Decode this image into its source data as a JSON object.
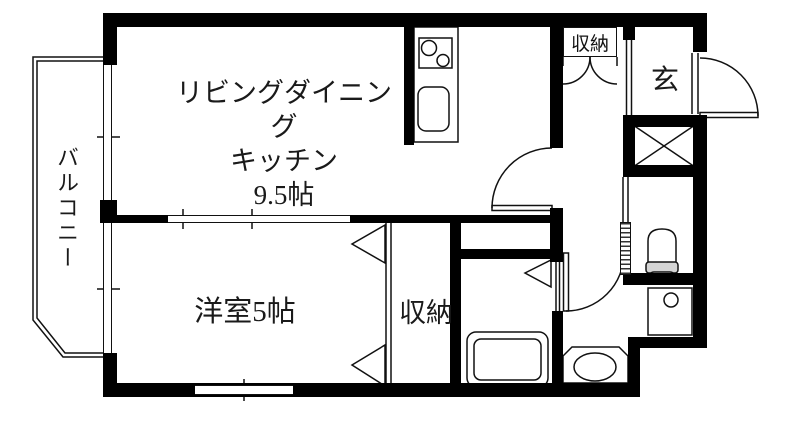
{
  "plan": {
    "ldk": {
      "name_line1": "リビングダイニング",
      "name_line2": "キッチン",
      "size": "9.5帖"
    },
    "western_room": {
      "name": "洋室5帖"
    },
    "closet_west": {
      "name": "収納"
    },
    "closet_hall": {
      "name": "収納"
    },
    "entrance": {
      "name": "玄"
    },
    "balcony": {
      "name": "バルコニー"
    },
    "fixtures": [
      "gas-stove",
      "kitchen-sink",
      "bathtub",
      "toilet",
      "wash-basin",
      "washing-machine-pan",
      "pipe-shaft",
      "front-door",
      "interior-doors",
      "sliding-windows",
      "folding-closet-doors"
    ],
    "colors": {
      "wall": "#000000",
      "background": "#ffffff",
      "linework": "#111111",
      "toilet_seat": "#d4d4d4"
    }
  }
}
